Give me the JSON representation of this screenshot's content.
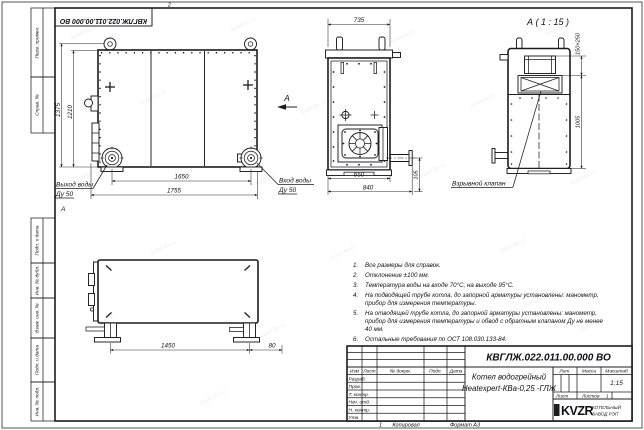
{
  "sheet": {
    "stamp_top": "КВГЛЖ.022.011.00.000 ВО",
    "top_mark": "2",
    "zone_mark": "А",
    "bottom_sheet_mark": "1",
    "copied_label": "Копировал",
    "format_label": "Формат А3",
    "margin_fields": [
      "Перв. примен.",
      "Справ. №",
      "Подп. и дата",
      "Инв. № дубл.",
      "Взам. инв. №",
      "Подп. и дата",
      "Инв. № подл."
    ]
  },
  "front_view": {
    "dim_height_total": "1375",
    "dim_height_body": "1210",
    "dim_width_flanges": "1650",
    "dim_width_total": "1755",
    "outlet_label": "Выход воды",
    "outlet_dn": "Ду 50",
    "inlet_label": "Вход воды",
    "inlet_dn": "Ду 50",
    "view_arrow": "А"
  },
  "side_view": {
    "dim_width_top": "735",
    "dim_width_body": "650",
    "dim_width_total": "840",
    "dim_pipe_height": "105"
  },
  "detail_view": {
    "title": "А ( 1 : 15 )",
    "dim_valve": "150×250",
    "dim_height": "1005",
    "valve_label": "Взрывной клапан"
  },
  "plan_view": {
    "dim_length": "1450",
    "dim_offset": "80"
  },
  "notes": {
    "items": [
      {
        "num": "1.",
        "text": "Все размеры для справок."
      },
      {
        "num": "2.",
        "text": "Отклонение ±100 мм."
      },
      {
        "num": "3.",
        "text": "Температура воды на входе 70°С, на выходе 95°С."
      },
      {
        "num": "4.",
        "text": "На подводящей трубе котла, до запорной арматуры установлены: манометр, прибор для измерения температуры."
      },
      {
        "num": "5.",
        "text": "На отводящей трубе котла, до запорной арматуры установлены: манометр, прибор для измерения температуры и обвод с обратным клапаном Ду не менее 40 мм."
      },
      {
        "num": "6.",
        "text": "Остальные требования по ОСТ 108.030.133-84."
      }
    ]
  },
  "title_block": {
    "doc_number": "КВГЛЖ.022.011.00.000 ВО",
    "product_line1": "Котел водогрейный",
    "product_line2": "Heatexpert-КВа-0,25 -ГЛЖ",
    "col_izm": "Изм",
    "col_list": "Лист",
    "col_doc": "№ докум.",
    "col_sign": "Подп.",
    "col_date": "Дата",
    "row_labels": [
      "Разраб.",
      "Пров.",
      "Т. контр.",
      "Нач. отд.",
      "Н. контр.",
      "Утв."
    ],
    "lit_label": "Лит.",
    "mass_label": "Масса",
    "scale_label": "Масштаб",
    "scale_value": "1:15",
    "sheet_label": "Лист",
    "sheets_label": "Листов",
    "sheets_value": "1",
    "company_logo": "KVZR",
    "company_line1": "КОТЕЛЬНЫЙ",
    "company_line2": "ЗАВОД РЭП"
  },
  "watermark": "kotel-kv.ru",
  "colors": {
    "line": "#1c1c1e",
    "watermark": "rgba(0,0,0,0.075)"
  }
}
